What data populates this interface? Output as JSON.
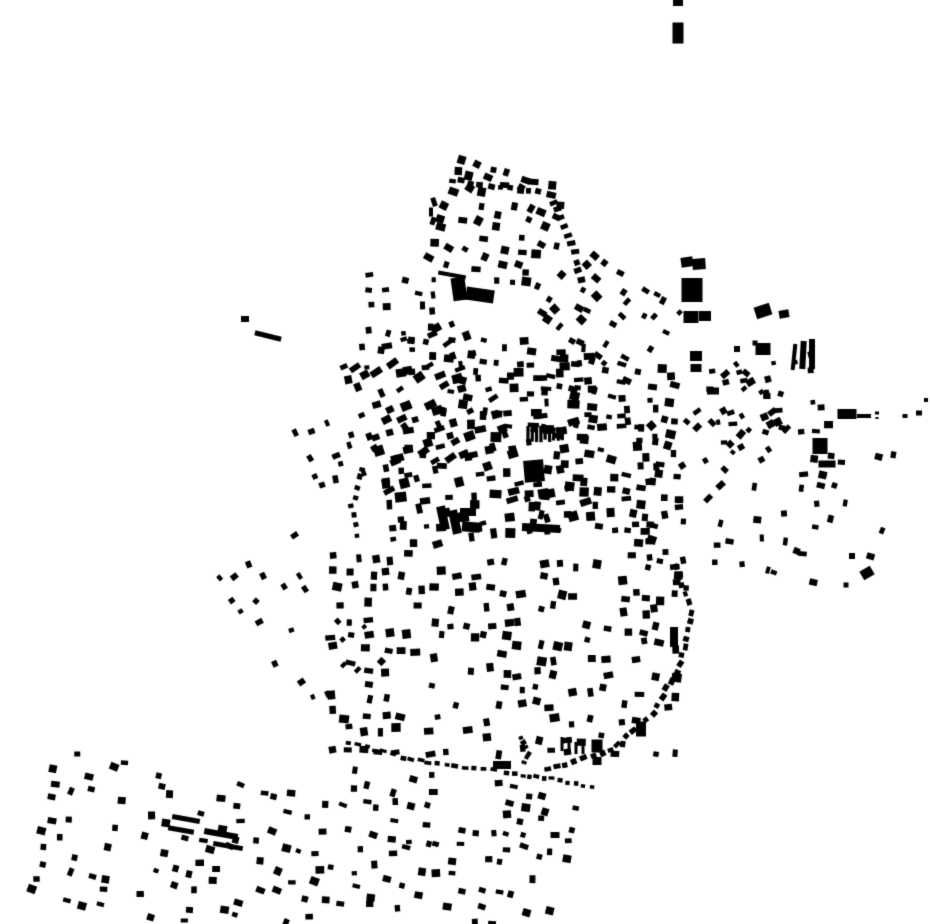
{
  "map": {
    "width": 930,
    "height": 924,
    "background_color": "#ffffff",
    "building_color": "#000000",
    "clusters": [
      {
        "name": "north-grid",
        "cx": 500,
        "cy": 228,
        "w": 112,
        "h": 112,
        "rot": 16,
        "pitch_x": 16,
        "pitch_y": 15,
        "density": 0.78,
        "bw": [
          5,
          10
        ],
        "bh": [
          5,
          9
        ],
        "jitter": 5,
        "angle_jitter": 16,
        "seed": 11
      },
      {
        "name": "north-west-column",
        "cx": 400,
        "cy": 320,
        "w": 62,
        "h": 85,
        "rot": 6,
        "pitch_x": 16,
        "pitch_y": 15,
        "density": 0.5,
        "bw": [
          4,
          8
        ],
        "bh": [
          4,
          8
        ],
        "jitter": 5,
        "angle_jitter": 14,
        "seed": 12
      },
      {
        "name": "northeast-rows",
        "cx": 606,
        "cy": 314,
        "w": 112,
        "h": 82,
        "rot": 36,
        "pitch_x": 14,
        "pitch_y": 16,
        "density": 0.55,
        "bw": [
          4,
          9
        ],
        "bh": [
          4,
          8
        ],
        "jitter": 5,
        "angle_jitter": 12,
        "seed": 13
      },
      {
        "name": "core-northwest",
        "cx": 424,
        "cy": 400,
        "w": 122,
        "h": 122,
        "rot": -22,
        "pitch_x": 15,
        "pitch_y": 14,
        "density": 0.7,
        "bw": [
          5,
          12
        ],
        "bh": [
          4,
          9
        ],
        "jitter": 6,
        "angle_jitter": 14,
        "seed": 14
      },
      {
        "name": "core-north",
        "cx": 521,
        "cy": 386,
        "w": 142,
        "h": 80,
        "rot": 4,
        "pitch_x": 14,
        "pitch_y": 13,
        "density": 0.78,
        "bw": [
          4,
          11
        ],
        "bh": [
          4,
          9
        ],
        "jitter": 6,
        "angle_jitter": 12,
        "seed": 15
      },
      {
        "name": "core-center",
        "cx": 481,
        "cy": 474,
        "w": 190,
        "h": 108,
        "rot": -8,
        "pitch_x": 15,
        "pitch_y": 14,
        "density": 0.74,
        "bw": [
          5,
          12
        ],
        "bh": [
          4,
          10
        ],
        "jitter": 6,
        "angle_jitter": 12,
        "seed": 16
      },
      {
        "name": "core-east",
        "cx": 604,
        "cy": 452,
        "w": 132,
        "h": 172,
        "rot": 6,
        "pitch_x": 16,
        "pitch_y": 15,
        "density": 0.66,
        "bw": [
          5,
          10
        ],
        "bh": [
          4,
          9
        ],
        "jitter": 6,
        "angle_jitter": 12,
        "seed": 17
      },
      {
        "name": "core-southeast-edge",
        "cx": 656,
        "cy": 495,
        "w": 48,
        "h": 175,
        "rot": -4,
        "pitch_x": 15,
        "pitch_y": 15,
        "density": 0.55,
        "bw": [
          5,
          9
        ],
        "bh": [
          5,
          8
        ],
        "jitter": 5,
        "angle_jitter": 10,
        "seed": 18
      },
      {
        "name": "east-diagonal-rows",
        "cx": 722,
        "cy": 432,
        "w": 100,
        "h": 96,
        "rot": -38,
        "pitch_x": 15,
        "pitch_y": 15,
        "density": 0.5,
        "bw": [
          4,
          9
        ],
        "bh": [
          4,
          8
        ],
        "jitter": 5,
        "angle_jitter": 12,
        "seed": 19
      },
      {
        "name": "east-middle",
        "cx": 770,
        "cy": 482,
        "w": 95,
        "h": 168,
        "rot": 6,
        "pitch_x": 17,
        "pitch_y": 17,
        "density": 0.42,
        "bw": [
          4,
          9
        ],
        "bh": [
          4,
          8
        ],
        "jitter": 6,
        "angle_jitter": 14,
        "seed": 20
      },
      {
        "name": "east-right",
        "cx": 833,
        "cy": 520,
        "w": 85,
        "h": 150,
        "rot": 12,
        "pitch_x": 18,
        "pitch_y": 18,
        "density": 0.32,
        "bw": [
          4,
          8
        ],
        "bh": [
          4,
          8
        ],
        "jitter": 6,
        "angle_jitter": 14,
        "seed": 21
      },
      {
        "name": "east-upper",
        "cx": 745,
        "cy": 396,
        "w": 120,
        "h": 52,
        "rot": -10,
        "pitch_x": 16,
        "pitch_y": 15,
        "density": 0.4,
        "bw": [
          4,
          8
        ],
        "bh": [
          4,
          7
        ],
        "jitter": 6,
        "angle_jitter": 14,
        "seed": 22
      },
      {
        "name": "south-grid",
        "cx": 500,
        "cy": 658,
        "w": 332,
        "h": 196,
        "rot": 2,
        "pitch_x": 17,
        "pitch_y": 16,
        "density": 0.62,
        "bw": [
          5,
          10
        ],
        "bh": [
          5,
          9
        ],
        "jitter": 5,
        "angle_jitter": 13,
        "seed": 23
      },
      {
        "name": "west-scatter",
        "cx": 297,
        "cy": 620,
        "w": 95,
        "h": 150,
        "rot": -33,
        "pitch_x": 19,
        "pitch_y": 19,
        "density": 0.38,
        "bw": [
          4,
          8
        ],
        "bh": [
          4,
          7
        ],
        "jitter": 6,
        "angle_jitter": 14,
        "seed": 24
      },
      {
        "name": "southwest-village",
        "cx": 185,
        "cy": 852,
        "w": 282,
        "h": 148,
        "rot": 11,
        "pitch_x": 17,
        "pitch_y": 16,
        "density": 0.5,
        "bw": [
          5,
          9
        ],
        "bh": [
          4,
          8
        ],
        "jitter": 5,
        "angle_jitter": 13,
        "seed": 25
      },
      {
        "name": "south-village",
        "cx": 456,
        "cy": 854,
        "w": 226,
        "h": 142,
        "rot": 7,
        "pitch_x": 16,
        "pitch_y": 15,
        "density": 0.56,
        "bw": [
          5,
          9
        ],
        "bh": [
          4,
          8
        ],
        "jitter": 5,
        "angle_jitter": 13,
        "seed": 26
      },
      {
        "name": "west-clump",
        "cx": 330,
        "cy": 456,
        "w": 40,
        "h": 58,
        "rot": -20,
        "pitch_x": 15,
        "pitch_y": 14,
        "density": 0.5,
        "bw": [
          4,
          9
        ],
        "bh": [
          4,
          8
        ],
        "jitter": 5,
        "angle_jitter": 12,
        "seed": 27
      }
    ],
    "chains": [
      {
        "name": "north-top-edge",
        "points": [
          [
            452,
            180
          ],
          [
            500,
            187
          ],
          [
            548,
            194
          ]
        ],
        "step": 9,
        "bw": 6,
        "bh": 5,
        "jitter": 1.5,
        "seed": 31
      },
      {
        "name": "north-right-edge",
        "points": [
          [
            554,
            202
          ],
          [
            572,
            244
          ],
          [
            583,
            288
          ]
        ],
        "step": 10,
        "bw": 5,
        "bh": 7,
        "jitter": 1.5,
        "seed": 32
      },
      {
        "name": "south-curved-boundary",
        "points": [
          [
            676,
            566
          ],
          [
            691,
            612
          ],
          [
            681,
            664
          ],
          [
            653,
            714
          ],
          [
            611,
            749
          ],
          [
            566,
            765
          ],
          [
            540,
            773
          ]
        ],
        "step": 9,
        "bw": 6,
        "bh": 5,
        "jitter": 1.5,
        "seed": 33
      },
      {
        "name": "south-bottom-edge",
        "points": [
          [
            348,
            742
          ],
          [
            402,
            757
          ],
          [
            455,
            767
          ],
          [
            502,
            771
          ]
        ],
        "step": 9,
        "bw": 6,
        "bh": 4,
        "jitter": 1.5,
        "seed": 34
      },
      {
        "name": "south-bottom-edge-2",
        "points": [
          [
            508,
            773
          ],
          [
            560,
            780
          ],
          [
            600,
            788
          ]
        ],
        "step": 8,
        "bw": 5,
        "bh": 4,
        "jitter": 1.5,
        "seed": 35
      },
      {
        "name": "snake-column",
        "points": [
          [
            520,
            737
          ],
          [
            528,
            753
          ],
          [
            521,
            768
          ]
        ],
        "step": 6,
        "bw": 4,
        "bh": 5,
        "jitter": 1,
        "seed": 36
      },
      {
        "name": "core-west-edge",
        "points": [
          [
            362,
            468
          ],
          [
            352,
            506
          ],
          [
            357,
            544
          ]
        ],
        "step": 10,
        "bw": 5,
        "bh": 5,
        "jitter": 1.5,
        "seed": 37
      }
    ],
    "hatches": [
      {
        "name": "rowhouse-strip",
        "x": 528,
        "y": 434,
        "count": 9,
        "step": 4.3,
        "bw": 3.2,
        "bh": 14,
        "rot": 0,
        "seed": 41
      }
    ],
    "landmarks": [
      [
        678,
        3,
        10,
        6,
        0
      ],
      [
        678,
        33,
        11,
        21,
        0
      ],
      [
        245,
        319,
        8,
        6,
        0
      ],
      [
        268,
        336,
        27,
        5,
        14
      ],
      [
        687,
        262,
        12,
        10,
        -8
      ],
      [
        699,
        264,
        13,
        11,
        -4
      ],
      [
        692,
        290,
        21,
        24,
        0
      ],
      [
        691,
        317,
        15,
        12,
        0
      ],
      [
        705,
        316,
        12,
        10,
        0
      ],
      [
        763,
        311,
        16,
        12,
        -18
      ],
      [
        784,
        314,
        10,
        8,
        -10
      ],
      [
        763,
        349,
        15,
        12,
        0
      ],
      [
        755,
        343,
        5,
        5,
        0
      ],
      [
        737,
        349,
        6,
        6,
        0
      ],
      [
        696,
        356,
        12,
        10,
        0
      ],
      [
        696,
        368,
        11,
        8,
        0
      ],
      [
        794,
        357,
        4,
        26,
        6
      ],
      [
        803,
        355,
        6,
        28,
        3
      ],
      [
        812,
        354,
        6,
        30,
        0
      ],
      [
        713,
        391,
        12,
        7,
        0
      ],
      [
        847,
        414,
        19,
        10,
        0
      ],
      [
        864,
        416,
        14,
        4,
        0
      ],
      [
        877,
        413,
        4,
        3,
        0
      ],
      [
        877,
        418,
        3,
        2,
        0
      ],
      [
        820,
        446,
        15,
        16,
        0
      ],
      [
        827,
        464,
        17,
        7,
        0
      ],
      [
        674,
        637,
        8,
        20,
        0
      ],
      [
        534,
        471,
        20,
        22,
        -5
      ],
      [
        541,
        528,
        38,
        8,
        3
      ],
      [
        443,
        518,
        9,
        24,
        -12
      ],
      [
        455,
        522,
        9,
        24,
        -12
      ],
      [
        468,
        512,
        16,
        8,
        0
      ],
      [
        471,
        527,
        18,
        10,
        5
      ],
      [
        459,
        289,
        14,
        23,
        -8
      ],
      [
        480,
        295,
        28,
        13,
        8
      ],
      [
        452,
        275,
        28,
        4,
        10
      ],
      [
        434,
        202,
        5,
        9,
        -18
      ],
      [
        431,
        212,
        4,
        9,
        0
      ],
      [
        433,
        221,
        5,
        8,
        18
      ],
      [
        186,
        819,
        28,
        5,
        10
      ],
      [
        181,
        830,
        26,
        5,
        10
      ],
      [
        221,
        834,
        34,
        6,
        10
      ],
      [
        228,
        846,
        30,
        5,
        10
      ],
      [
        597,
        746,
        11,
        13,
        0
      ],
      [
        597,
        761,
        9,
        8,
        0
      ],
      [
        641,
        729,
        10,
        15,
        0
      ],
      [
        502,
        765,
        18,
        8,
        0
      ],
      [
        562,
        744,
        3,
        14,
        0
      ],
      [
        569,
        744,
        3,
        14,
        0
      ],
      [
        576,
        748,
        3,
        12,
        0
      ],
      [
        583,
        748,
        3,
        12,
        0
      ],
      [
        905,
        416,
        5,
        4,
        0
      ],
      [
        919,
        413,
        6,
        5,
        0
      ],
      [
        926,
        400,
        4,
        4,
        0
      ],
      [
        867,
        573,
        12,
        10,
        -30
      ],
      [
        852,
        556,
        6,
        6,
        0
      ],
      [
        846,
        585,
        5,
        5,
        0
      ]
    ]
  }
}
